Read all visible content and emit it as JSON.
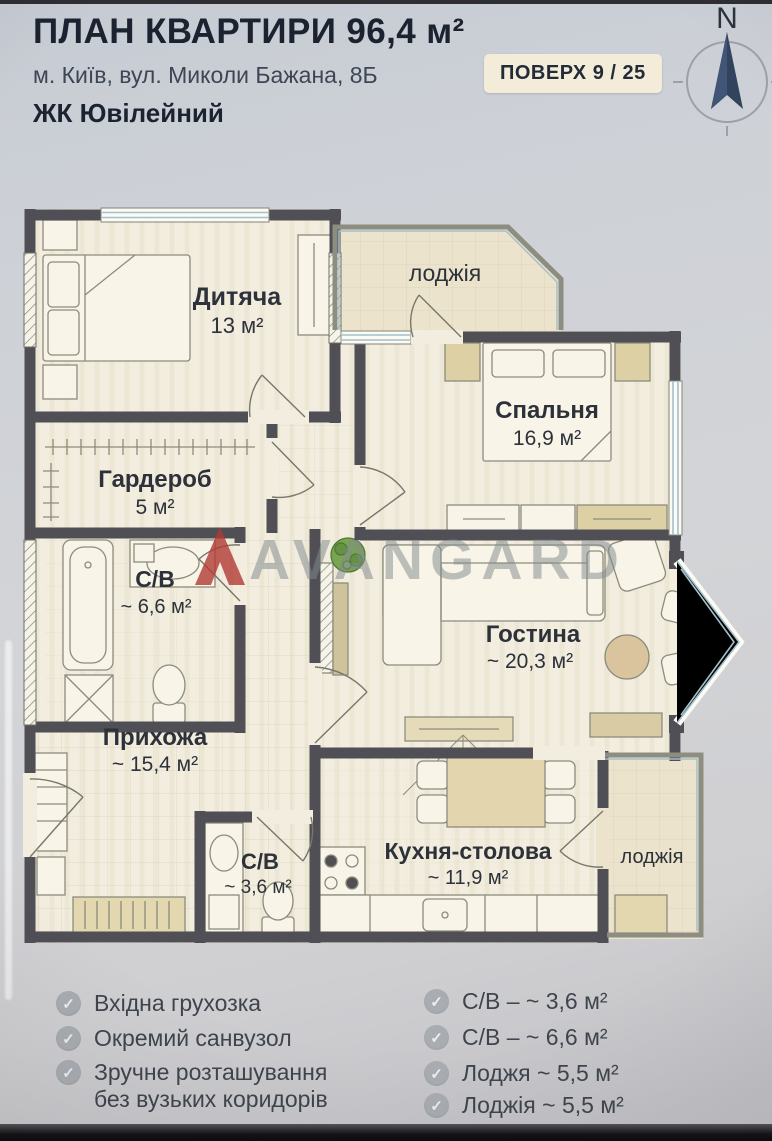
{
  "header": {
    "title": "ПЛАН КВАРТИРИ 96,4 м²",
    "address": "м. Київ, вул. Миколи Бажана, 8Б",
    "floor_badge": "ПОВЕРХ 9 / 25",
    "complex": "ЖК Ювілейний",
    "compass_label": "N"
  },
  "plan": {
    "watermark": "AVANGARD",
    "rooms": {
      "dytiacha": {
        "name": "Дитяча",
        "area": "13 м²"
      },
      "loggia_top": {
        "name": "лоджія"
      },
      "spalnia": {
        "name": "Спальня",
        "area": "16,9 м²"
      },
      "harderob": {
        "name": "Гардероб",
        "area": "5 м²"
      },
      "sv_big": {
        "name": "С/В",
        "area": "~ 6,6 м²"
      },
      "hostyna": {
        "name": "Гостина",
        "area": "~ 20,3 м²"
      },
      "prykhozha": {
        "name": "Прихожа",
        "area": "~ 15,4 м²"
      },
      "sv_small": {
        "name": "С/В",
        "area": "~ 3,6 м²"
      },
      "kukhnia": {
        "name": "Кухня-столова",
        "area": "~ 11,9 м²"
      },
      "loggia_bottom": {
        "name": "лоджія"
      }
    }
  },
  "features": {
    "left": [
      {
        "line1": "Вхідна грухозка",
        "line2": ""
      },
      {
        "line1": "Окремий санвузол",
        "line2": ""
      },
      {
        "line1": "Зручне розташування",
        "line2": "без вузьких коридорів"
      }
    ],
    "right": [
      {
        "line1": "С/В – ~ 3,6 м²"
      },
      {
        "line1": "С/В – ~ 6,6 м²"
      },
      {
        "line1": "Лоджя ~ 5,5 м²"
      },
      {
        "line1": "Лоджія ~ 5,5 м²"
      }
    ]
  },
  "icons": {
    "check": "✓"
  },
  "colors": {
    "accent_red": "#b23a35",
    "wall": "#4f4f55",
    "paper": "#f2edde"
  }
}
